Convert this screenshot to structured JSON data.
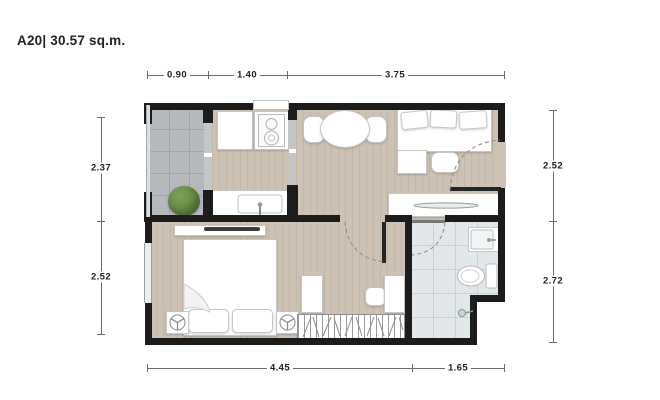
{
  "title": "A20| 30.57 sq.m.",
  "dimensions": {
    "top": [
      "0.90",
      "1.40",
      "3.75"
    ],
    "bottom": [
      "4.45",
      "1.65"
    ],
    "left": [
      "2.37",
      "2.52"
    ],
    "right": [
      "2.52",
      "2.72"
    ]
  },
  "colors": {
    "wall": "#1c1c1c",
    "wood_floor": "#cdc2b3",
    "wood_stripe": "#c3b7a7",
    "balcony_tile": "#b5b9bb",
    "balcony_grid": "#9fa5a8",
    "bath_tile": "#e2e8e9",
    "bath_grid": "#c9d3d6",
    "furniture": "#ffffff",
    "furniture_border": "#c6c6c4",
    "plant_light": "#7fa356",
    "plant_dark": "#47632e",
    "dim_line": "#6b6b6b",
    "text": "#222222",
    "door_arc": "#9a8d7e"
  }
}
